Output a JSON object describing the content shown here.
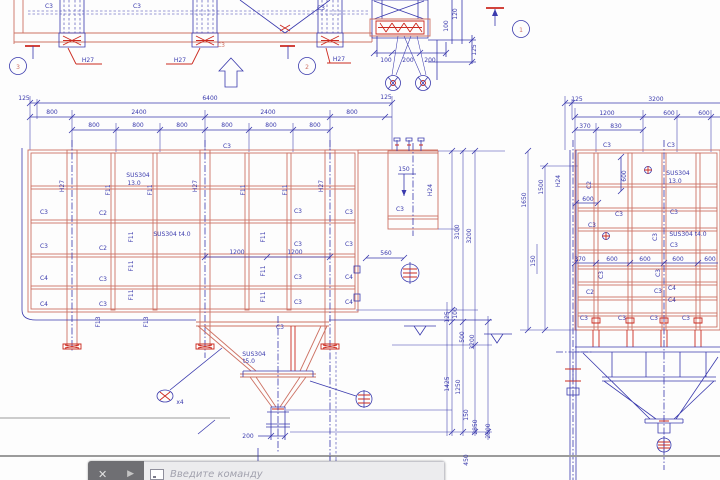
{
  "colors": {
    "blue": "#3a3aad",
    "red": "#cc2a20",
    "salmon": "#cd7264",
    "grey": "#9b9b9b",
    "bardark": "#6f6f73",
    "barlight": "#ececee",
    "hint": "#a2a2ae"
  },
  "toolbar": {
    "close_icon": "✕",
    "arrow_icon": "▶",
    "prompt_icon_name": "command-prompt-icon",
    "placeholder": "Введите команду"
  },
  "drawing": {
    "material_notes": [
      "SUS304 13.0",
      "SUS304 t4.0",
      "SUS304 t5.0"
    ],
    "section_balloons": [
      "1",
      "2",
      "3"
    ],
    "labels": [
      {
        "t": "C3",
        "x": 49,
        "y": 8
      },
      {
        "t": "C3",
        "x": 137,
        "y": 8
      },
      {
        "t": "C3",
        "x": 321,
        "y": 10
      },
      {
        "t": "C3",
        "x": 221,
        "y": 47,
        "c": "ts"
      },
      {
        "t": "H27",
        "x": 88,
        "y": 62
      },
      {
        "t": "H27",
        "x": 180,
        "y": 62
      },
      {
        "t": "H27",
        "x": 339,
        "y": 61
      },
      {
        "t": "3",
        "x": 18,
        "y": 69,
        "c": "ts",
        "s": 8
      },
      {
        "t": "2",
        "x": 307,
        "y": 69,
        "c": "ts",
        "s": 8
      },
      {
        "t": "1",
        "x": 521,
        "y": 32,
        "c": "ts",
        "s": 8
      },
      {
        "t": "100",
        "x": 386,
        "y": 62
      },
      {
        "t": "200",
        "x": 408,
        "y": 62
      },
      {
        "t": "200",
        "x": 430,
        "y": 62
      },
      {
        "t": "120",
        "x": 457,
        "y": 14,
        "r": -90
      },
      {
        "t": "100",
        "x": 448,
        "y": 26,
        "r": -90
      },
      {
        "t": "125",
        "x": 476,
        "y": 50,
        "r": -90
      },
      {
        "t": "125",
        "x": 24,
        "y": 100
      },
      {
        "t": "6400",
        "x": 210,
        "y": 100
      },
      {
        "t": "800",
        "x": 52,
        "y": 114
      },
      {
        "t": "2400",
        "x": 139,
        "y": 114
      },
      {
        "t": "2400",
        "x": 268,
        "y": 114
      },
      {
        "t": "800",
        "x": 352,
        "y": 114
      },
      {
        "t": "800",
        "x": 94,
        "y": 127
      },
      {
        "t": "800",
        "x": 138,
        "y": 127
      },
      {
        "t": "800",
        "x": 182,
        "y": 127
      },
      {
        "t": "800",
        "x": 227,
        "y": 127
      },
      {
        "t": "800",
        "x": 271,
        "y": 127
      },
      {
        "t": "800",
        "x": 315,
        "y": 127
      },
      {
        "t": "C3",
        "x": 227,
        "y": 148
      },
      {
        "t": "125",
        "x": 386,
        "y": 99
      },
      {
        "t": "H27",
        "x": 64,
        "y": 186,
        "r": -90
      },
      {
        "t": "H27",
        "x": 197,
        "y": 186,
        "r": -90
      },
      {
        "t": "H27",
        "x": 323,
        "y": 186,
        "r": -90
      },
      {
        "t": "F11",
        "x": 110,
        "y": 190,
        "r": -90
      },
      {
        "t": "F11",
        "x": 152,
        "y": 190,
        "r": -90
      },
      {
        "t": "F11",
        "x": 245,
        "y": 190,
        "r": -90
      },
      {
        "t": "F11",
        "x": 287,
        "y": 190,
        "r": -90
      },
      {
        "t": "SUS304",
        "x": 138,
        "y": 177
      },
      {
        "t": "13.0",
        "x": 134,
        "y": 185
      },
      {
        "t": "C3",
        "x": 44,
        "y": 214
      },
      {
        "t": "C3",
        "x": 44,
        "y": 248
      },
      {
        "t": "C4",
        "x": 44,
        "y": 280
      },
      {
        "t": "C4",
        "x": 44,
        "y": 306
      },
      {
        "t": "C2",
        "x": 103,
        "y": 215
      },
      {
        "t": "C2",
        "x": 103,
        "y": 250
      },
      {
        "t": "C3",
        "x": 103,
        "y": 281
      },
      {
        "t": "C3",
        "x": 103,
        "y": 306
      },
      {
        "t": "C3",
        "x": 298,
        "y": 213
      },
      {
        "t": "C3",
        "x": 298,
        "y": 246
      },
      {
        "t": "C3",
        "x": 298,
        "y": 279
      },
      {
        "t": "C3",
        "x": 298,
        "y": 304
      },
      {
        "t": "C3",
        "x": 349,
        "y": 214
      },
      {
        "t": "C3",
        "x": 349,
        "y": 246
      },
      {
        "t": "C4",
        "x": 349,
        "y": 279
      },
      {
        "t": "C4",
        "x": 349,
        "y": 304
      },
      {
        "t": "F11",
        "x": 133,
        "y": 237,
        "r": -90
      },
      {
        "t": "F11",
        "x": 133,
        "y": 266,
        "r": -90
      },
      {
        "t": "F11",
        "x": 133,
        "y": 295,
        "r": -90
      },
      {
        "t": "F11",
        "x": 265,
        "y": 237,
        "r": -90
      },
      {
        "t": "F11",
        "x": 265,
        "y": 271,
        "r": -90
      },
      {
        "t": "F11",
        "x": 265,
        "y": 297,
        "r": -90
      },
      {
        "t": "SUS304 t4.0",
        "x": 172,
        "y": 236
      },
      {
        "t": "1200",
        "x": 237,
        "y": 254
      },
      {
        "t": "1200",
        "x": 295,
        "y": 254
      },
      {
        "t": "560",
        "x": 386,
        "y": 255
      },
      {
        "t": "F13",
        "x": 100,
        "y": 322,
        "r": -90
      },
      {
        "t": "F13",
        "x": 148,
        "y": 322,
        "r": -90
      },
      {
        "t": "C3",
        "x": 400,
        "y": 211
      },
      {
        "t": "150",
        "x": 404,
        "y": 171
      },
      {
        "t": "H24",
        "x": 432,
        "y": 190,
        "r": -90
      },
      {
        "t": "C3",
        "x": 280,
        "y": 329
      },
      {
        "t": "SUS304",
        "x": 254,
        "y": 356
      },
      {
        "t": "t5.0",
        "x": 249,
        "y": 363
      },
      {
        "t": "200",
        "x": 248,
        "y": 438
      },
      {
        "t": "x4",
        "x": 180,
        "y": 404,
        "s": 5
      },
      {
        "t": "3100",
        "x": 459,
        "y": 232,
        "r": -90
      },
      {
        "t": "3200",
        "x": 471,
        "y": 236,
        "r": -90
      },
      {
        "t": "125",
        "x": 449,
        "y": 317,
        "r": -90
      },
      {
        "t": "100",
        "x": 457,
        "y": 313,
        "r": -90
      },
      {
        "t": "500",
        "x": 464,
        "y": 337,
        "r": -90
      },
      {
        "t": "3200",
        "x": 474,
        "y": 342,
        "r": -90
      },
      {
        "t": "1425",
        "x": 449,
        "y": 384,
        "r": -90
      },
      {
        "t": "1250",
        "x": 460,
        "y": 387,
        "r": -90
      },
      {
        "t": "150",
        "x": 468,
        "y": 415,
        "r": -90
      },
      {
        "t": "2850",
        "x": 477,
        "y": 427,
        "r": -90
      },
      {
        "t": "2800",
        "x": 490,
        "y": 431,
        "r": -90
      },
      {
        "t": "450",
        "x": 468,
        "y": 460,
        "r": -90
      },
      {
        "t": "1650",
        "x": 526,
        "y": 200,
        "r": -90
      },
      {
        "t": "1500",
        "x": 543,
        "y": 187,
        "r": -90
      },
      {
        "t": "150",
        "x": 535,
        "y": 261,
        "r": -90
      },
      {
        "t": "125",
        "x": 577,
        "y": 101
      },
      {
        "t": "3200",
        "x": 656,
        "y": 101
      },
      {
        "t": "1200",
        "x": 607,
        "y": 115
      },
      {
        "t": "600",
        "x": 669,
        "y": 115
      },
      {
        "t": "600",
        "x": 704,
        "y": 115
      },
      {
        "t": "370",
        "x": 585,
        "y": 128
      },
      {
        "t": "830",
        "x": 616,
        "y": 128
      },
      {
        "t": "C3",
        "x": 607,
        "y": 147
      },
      {
        "t": "C3",
        "x": 671,
        "y": 147
      },
      {
        "t": "600",
        "x": 626,
        "y": 176,
        "r": -90
      },
      {
        "t": "SUS304",
        "x": 678,
        "y": 175
      },
      {
        "t": "13.0",
        "x": 675,
        "y": 183
      },
      {
        "t": "H24",
        "x": 560,
        "y": 181,
        "r": -90
      },
      {
        "t": "C2",
        "x": 591,
        "y": 185,
        "r": -90
      },
      {
        "t": "600",
        "x": 588,
        "y": 201
      },
      {
        "t": "C3",
        "x": 619,
        "y": 216
      },
      {
        "t": "C3",
        "x": 674,
        "y": 214
      },
      {
        "t": "C3",
        "x": 592,
        "y": 227
      },
      {
        "t": "SUS304 t4.0",
        "x": 688,
        "y": 236
      },
      {
        "t": "C3",
        "x": 674,
        "y": 247
      },
      {
        "t": "C3",
        "x": 657,
        "y": 237,
        "r": -90
      },
      {
        "t": "370",
        "x": 580,
        "y": 261
      },
      {
        "t": "600",
        "x": 612,
        "y": 261
      },
      {
        "t": "600",
        "x": 645,
        "y": 261
      },
      {
        "t": "600",
        "x": 678,
        "y": 261
      },
      {
        "t": "600",
        "x": 710,
        "y": 261
      },
      {
        "t": "C3",
        "x": 603,
        "y": 275,
        "r": -90
      },
      {
        "t": "C3",
        "x": 660,
        "y": 273,
        "r": -90
      },
      {
        "t": "C2",
        "x": 590,
        "y": 294
      },
      {
        "t": "C3",
        "x": 658,
        "y": 293
      },
      {
        "t": "C4",
        "x": 672,
        "y": 290
      },
      {
        "t": "C4",
        "x": 672,
        "y": 302
      },
      {
        "t": "C3",
        "x": 584,
        "y": 320
      },
      {
        "t": "C3",
        "x": 622,
        "y": 320
      },
      {
        "t": "C3",
        "x": 654,
        "y": 320
      },
      {
        "t": "C3",
        "x": 686,
        "y": 320
      }
    ]
  }
}
